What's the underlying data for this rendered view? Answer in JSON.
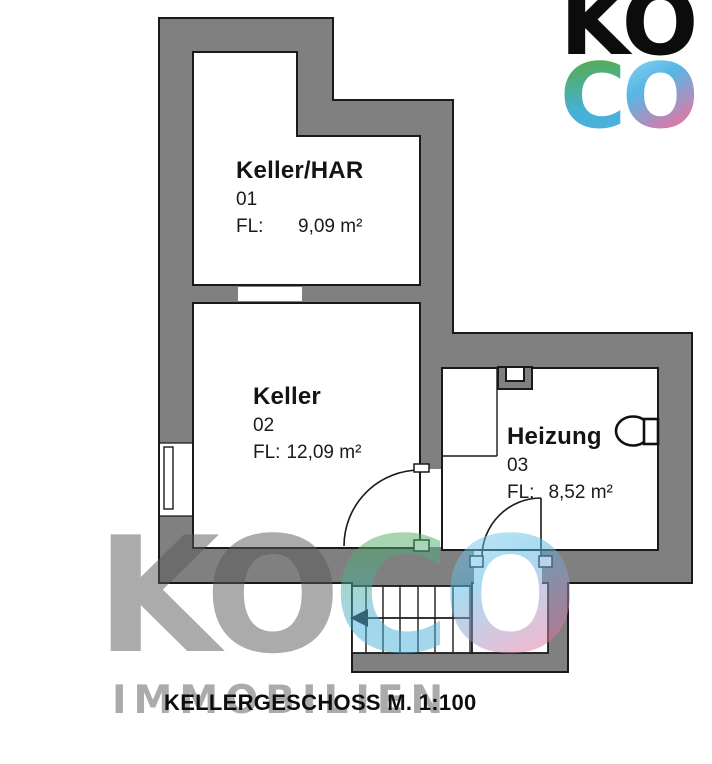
{
  "logo": {
    "line1": "KO",
    "c": "C",
    "o": "O"
  },
  "watermark": {
    "gray": "KO",
    "c": "C",
    "o": "O",
    "subtitle": "IMMOBILIEN"
  },
  "caption": "KELLERGESCHOSS M. 1:100",
  "rooms": [
    {
      "name": "Keller/HAR",
      "number": "01",
      "fl_label": "FL:",
      "area": "9,09 m²"
    },
    {
      "name": "Keller",
      "number": "02",
      "fl_label": "FL:",
      "area": "12,09 m²"
    },
    {
      "name": "Heizung",
      "number": "03",
      "fl_label": "FL:",
      "area": "8,52 m²"
    }
  ],
  "colors": {
    "wall": "#808080",
    "line": "#1a1a1a",
    "logo_green": "#58ab35",
    "logo_blue": "#47b2e0",
    "logo_pink": "#ef70a0",
    "watermark_gray": "#ababab"
  }
}
